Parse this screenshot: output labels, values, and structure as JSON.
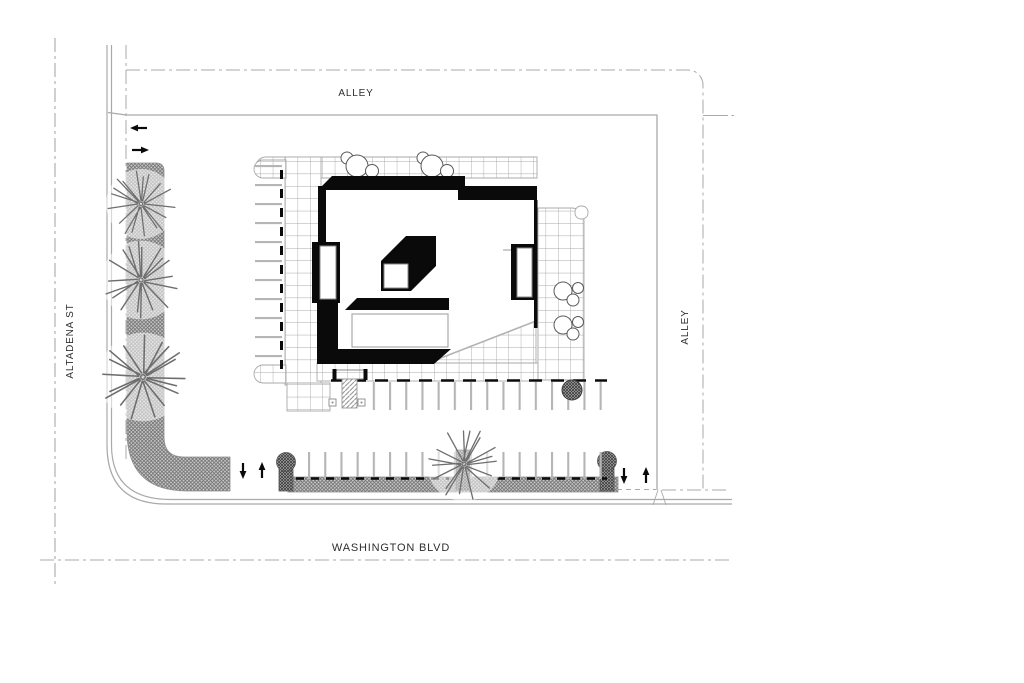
{
  "drawing": {
    "type": "architectural-site-plan",
    "labels": {
      "north_alley": "ALLEY",
      "west_street": "ALTADENA ST",
      "east_alley": "ALLEY",
      "south_street": "WASHINGTON BLVD"
    },
    "arrows": [
      {
        "id": "west-exit",
        "direction": "left"
      },
      {
        "id": "west-entry",
        "direction": "right"
      },
      {
        "id": "southwest-entry",
        "direction": "down"
      },
      {
        "id": "southwest-exit",
        "direction": "up"
      },
      {
        "id": "southeast-entry",
        "direction": "down"
      },
      {
        "id": "southeast-exit",
        "direction": "up"
      }
    ],
    "colors": {
      "ink": "#0a0a0a",
      "street_line_gray": "#a9a9a9",
      "grid_gray": "#a8a8a8",
      "stall_gray": "#b5b5b5",
      "hatch_dark": "#3d3d3d",
      "hatch_mid": "#6f6f6f",
      "label_text": "#2e2e2e",
      "paper": "#ffffff"
    }
  }
}
